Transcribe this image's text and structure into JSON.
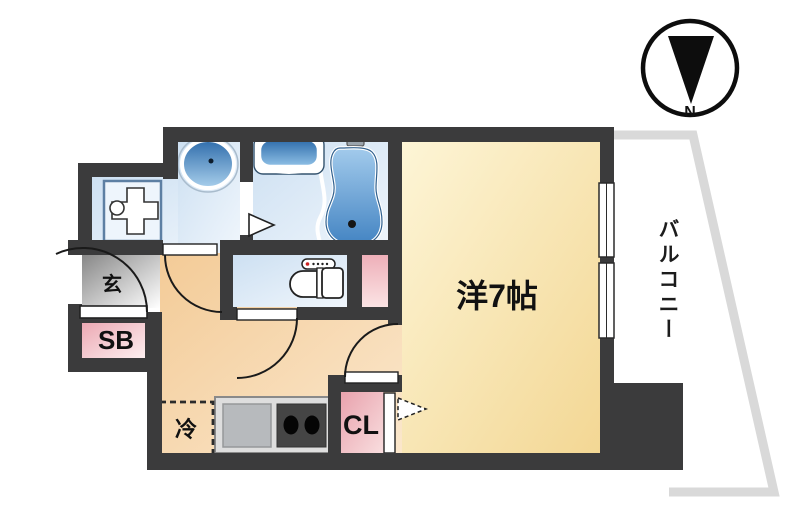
{
  "floor_plan": {
    "compass_label": "N",
    "balcony_label": "バルコニー",
    "main_room_label": "洋7帖",
    "entrance_label": "玄",
    "shoe_box_label": "SB",
    "closet_label": "CL",
    "refrigerator_label": "冷",
    "colors": {
      "wall": "#3b3b3c",
      "main_room": "#f6e2ab",
      "hallway": "#f5d1a2",
      "wet_area_floor": "#d9e8f6",
      "fixture_blue": "#4f8fc9",
      "pink_storage": "#efaeb8",
      "entrance_gray": "#8a8a8a",
      "balcony_outline": "#d9d9d9",
      "kitchen_counter": "#dedede",
      "stove": "#454545"
    }
  }
}
